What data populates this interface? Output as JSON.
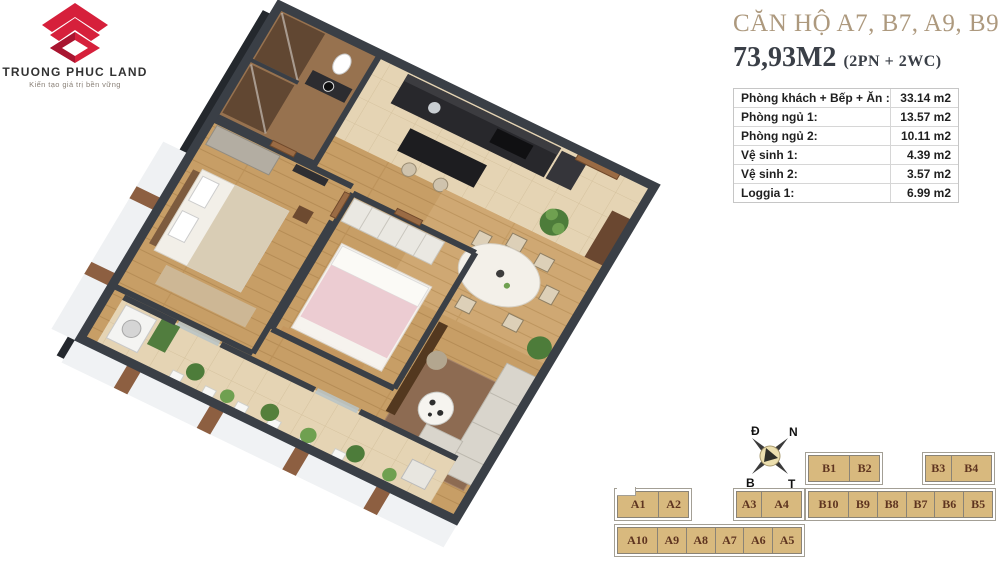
{
  "logo": {
    "company": "TRUONG PHUC LAND",
    "tagline": "Kiến tạo giá trị bền vững",
    "mark_icon": "brand-diamond-chevron-icon",
    "brand_red": "#d6203b",
    "brand_red_dark": "#a81530"
  },
  "header": {
    "title": "CĂN HỘ A7, B7, A9, B9",
    "area": "73,93M2",
    "area_note": "(2PN + 2WC)",
    "title_color": "#ad997e",
    "text_color": "#3a3f47"
  },
  "area_table": {
    "rows": [
      {
        "label": "Phòng khách + Bếp + Ăn :",
        "value": "33.14 m2"
      },
      {
        "label": "Phòng ngủ 1:",
        "value": "13.57 m2"
      },
      {
        "label": "Phòng ngủ 2:",
        "value": "10.11 m2"
      },
      {
        "label": "Vệ sinh 1:",
        "value": "4.39 m2"
      },
      {
        "label": "Vệ sinh 2:",
        "value": "3.57 m2"
      },
      {
        "label": "Loggia 1:",
        "value": "6.99 m2"
      }
    ]
  },
  "compass": {
    "icon": "compass-rose-icon",
    "top_left": "Đ",
    "top_right": "N",
    "bottom_left": "B",
    "bottom_right": "T"
  },
  "units": {
    "cell_fill": "#d8b97e",
    "cell_text_color": "#5e3420",
    "block_a": {
      "top_left": [
        "A1",
        "A2"
      ],
      "top_right": [
        "A3",
        "A4"
      ],
      "bottom": [
        "A10",
        "A9",
        "A8",
        "A7",
        "A6",
        "A5"
      ]
    },
    "block_b": {
      "top_left": [
        "B1",
        "B2"
      ],
      "top_right": [
        "B3",
        "B4"
      ],
      "bottom": [
        "B10",
        "B9",
        "B8",
        "B7",
        "B6",
        "B5"
      ]
    }
  },
  "floorplan": {
    "wall_color": "#3a3f46",
    "wood_floor": "#c79e66",
    "tile_floor": "#e5d4b4",
    "accent_green": "#4d7c3a"
  }
}
